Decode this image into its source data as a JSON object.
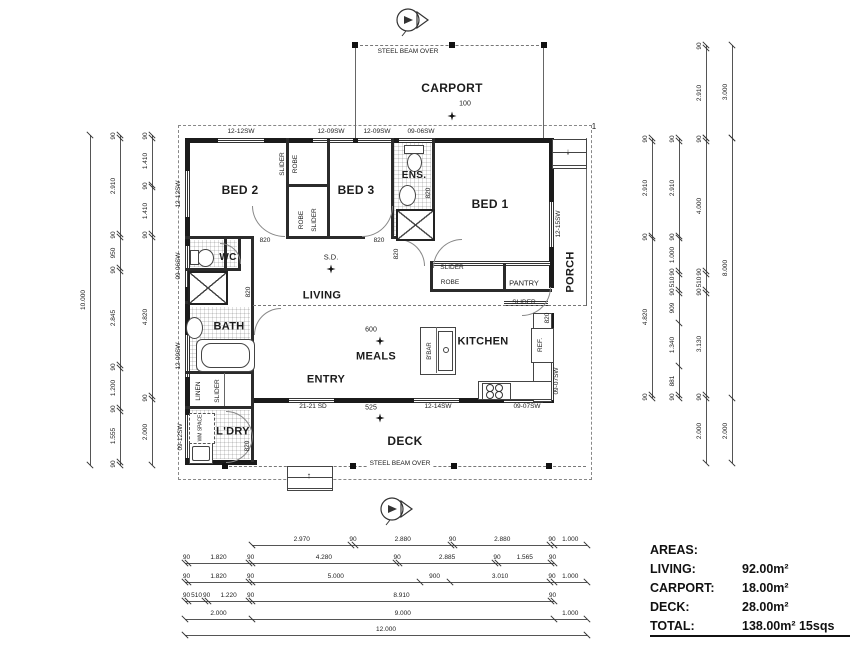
{
  "areas": {
    "title": "AREAS:",
    "rows": [
      {
        "label": "LIVING:",
        "value": "92.00m²"
      },
      {
        "label": "CARPORT:",
        "value": "18.00m²"
      },
      {
        "label": "DECK:",
        "value": "28.00m²"
      }
    ],
    "total": {
      "label": "TOTAL:",
      "value": "138.00m² 15sqs"
    }
  },
  "plan": {
    "labels": [
      {
        "t": "BED 2",
        "x": 240,
        "y": 190,
        "s": 12,
        "b": 1,
        "n": "room-bed2"
      },
      {
        "t": "BED 3",
        "x": 356,
        "y": 190,
        "s": 12,
        "b": 1,
        "n": "room-bed3"
      },
      {
        "t": "BED 1",
        "x": 490,
        "y": 204,
        "s": 12,
        "b": 1,
        "n": "room-bed1"
      },
      {
        "t": "ENS.",
        "x": 414,
        "y": 176,
        "s": 10,
        "b": 1,
        "n": "room-ensuite"
      },
      {
        "t": "WC",
        "x": 228,
        "y": 258,
        "s": 10,
        "b": 1,
        "n": "room-wc"
      },
      {
        "t": "BATH",
        "x": 229,
        "y": 327,
        "s": 11,
        "b": 1,
        "n": "room-bath"
      },
      {
        "t": "L'DRY",
        "x": 233,
        "y": 432,
        "s": 11,
        "b": 1,
        "n": "room-laundry"
      },
      {
        "t": "LIVING",
        "x": 322,
        "y": 296,
        "s": 11,
        "b": 1,
        "n": "room-living"
      },
      {
        "t": "MEALS",
        "x": 376,
        "y": 357,
        "s": 11,
        "b": 1,
        "n": "room-meals"
      },
      {
        "t": "KITCHEN",
        "x": 483,
        "y": 342,
        "s": 11,
        "b": 1,
        "n": "room-kitchen"
      },
      {
        "t": "ENTRY",
        "x": 326,
        "y": 380,
        "s": 11,
        "b": 1,
        "n": "room-entry"
      },
      {
        "t": "DECK",
        "x": 405,
        "y": 441,
        "s": 12,
        "b": 1,
        "n": "room-deck"
      },
      {
        "t": "CARPORT",
        "x": 452,
        "y": 88,
        "s": 12,
        "b": 1,
        "n": "room-carport"
      },
      {
        "t": "PORCH",
        "x": 571,
        "y": 272,
        "s": 11,
        "b": 1,
        "v": 1,
        "n": "room-porch"
      },
      {
        "t": "SLIDER",
        "x": 283,
        "y": 164,
        "v": 1,
        "n": "robe-slider-bed2"
      },
      {
        "t": "ROBE",
        "x": 296,
        "y": 164,
        "v": 1,
        "n": "robe-bed2"
      },
      {
        "t": "ROBE",
        "x": 302,
        "y": 220,
        "v": 1,
        "n": "robe-bed3"
      },
      {
        "t": "SLIDER",
        "x": 315,
        "y": 220,
        "v": 1,
        "n": "robe-slider-bed3"
      },
      {
        "t": "SLIDER",
        "x": 452,
        "y": 268,
        "n": "robe-slider-bed1"
      },
      {
        "t": "ROBE",
        "x": 450,
        "y": 283,
        "n": "robe-bed1"
      },
      {
        "t": "PANTRY",
        "x": 524,
        "y": 283,
        "s": 7.5,
        "n": "pantry"
      },
      {
        "t": "SLIDER",
        "x": 524,
        "y": 303,
        "n": "pantry-slider"
      },
      {
        "t": "LINEN",
        "x": 199,
        "y": 391,
        "v": 1,
        "n": "linen"
      },
      {
        "t": "SLIDER",
        "x": 218,
        "y": 391,
        "v": 1,
        "n": "linen-slider"
      },
      {
        "t": "WM SPACE",
        "x": 201,
        "y": 428,
        "v": 1,
        "s": 5,
        "n": "wm-space"
      },
      {
        "t": "REF.",
        "x": 541,
        "y": 345,
        "v": 1,
        "n": "fridge"
      },
      {
        "t": "B'BAR",
        "x": 430,
        "y": 351,
        "v": 1,
        "s": 6,
        "n": "breakfast-bar"
      },
      {
        "t": "12-12SW",
        "x": 241,
        "y": 132,
        "n": "window-top-1"
      },
      {
        "t": "12-09SW",
        "x": 331,
        "y": 132,
        "n": "window-top-2"
      },
      {
        "t": "12-09SW",
        "x": 377,
        "y": 132,
        "n": "window-top-3"
      },
      {
        "t": "09-06SW",
        "x": 421,
        "y": 132,
        "n": "window-top-4"
      },
      {
        "t": "12-12SW",
        "x": 179,
        "y": 194,
        "v": 1,
        "n": "window-left-1"
      },
      {
        "t": "09-06SW",
        "x": 179,
        "y": 266,
        "v": 1,
        "n": "window-left-2"
      },
      {
        "t": "12-09SW",
        "x": 179,
        "y": 356,
        "v": 1,
        "n": "window-left-3"
      },
      {
        "t": "09-12SW",
        "x": 181,
        "y": 437,
        "v": 1,
        "n": "window-left-4"
      },
      {
        "t": "12-15SW",
        "x": 559,
        "y": 224,
        "v": 1,
        "n": "window-right-1"
      },
      {
        "t": "09-07SW",
        "x": 557,
        "y": 381,
        "v": 1,
        "n": "window-right-2"
      },
      {
        "t": "21-21 SD",
        "x": 313,
        "y": 407,
        "n": "sliding-door-entry"
      },
      {
        "t": "12-14SW",
        "x": 438,
        "y": 407,
        "n": "window-bottom-1"
      },
      {
        "t": "09-07SW",
        "x": 527,
        "y": 407,
        "n": "window-bottom-2"
      },
      {
        "t": "820",
        "x": 265,
        "y": 241,
        "s": 6.5,
        "n": "door-820-bed2"
      },
      {
        "t": "820",
        "x": 379,
        "y": 241,
        "s": 6.5,
        "n": "door-820-bed3"
      },
      {
        "t": "820",
        "x": 397,
        "y": 254,
        "v": 1,
        "s": 6.5,
        "n": "door-820-hall"
      },
      {
        "t": "820",
        "x": 429,
        "y": 193,
        "v": 1,
        "s": 6.5,
        "n": "door-820-ens"
      },
      {
        "t": "820",
        "x": 548,
        "y": 318,
        "v": 1,
        "s": 6.5,
        "n": "door-820-porch"
      },
      {
        "t": "820",
        "x": 249,
        "y": 292,
        "v": 1,
        "s": 6.5,
        "n": "door-820-bath"
      },
      {
        "t": "820",
        "x": 248,
        "y": 446,
        "v": 1,
        "s": 6.5,
        "n": "door-820-laundry"
      },
      {
        "t": "STEEL BEAM OVER",
        "x": 408,
        "y": 52,
        "s": 6.5,
        "g": 1,
        "n": "steel-beam-over-top"
      },
      {
        "t": "STEEL BEAM OVER",
        "x": 400,
        "y": 464,
        "s": 6.5,
        "g": 1,
        "n": "steel-beam-over-bottom"
      },
      {
        "t": "100",
        "x": 465,
        "y": 104,
        "s": 7,
        "n": "post-size-100"
      },
      {
        "t": "600",
        "x": 371,
        "y": 330,
        "s": 7,
        "n": "post-size-600"
      },
      {
        "t": "525",
        "x": 371,
        "y": 408,
        "s": 7,
        "n": "post-size-525"
      },
      {
        "t": "S.D.",
        "x": 331,
        "y": 257,
        "s": 7.5,
        "n": "smoke-detector"
      },
      {
        "t": "1",
        "x": 594,
        "y": 127,
        "s": 8,
        "n": "grid-marker-1"
      },
      {
        "t": "↓",
        "x": 568,
        "y": 152,
        "s": 9,
        "n": "porch-steps-arrow"
      },
      {
        "t": "↑",
        "x": 309,
        "y": 476,
        "s": 9,
        "n": "deck-steps-arrow"
      }
    ],
    "dimensions": [
      {
        "n": "dim-left-overall",
        "dir": "v",
        "x": 90,
        "y": 135,
        "len": 330,
        "vals": [
          "10.000"
        ]
      },
      {
        "n": "dim-left-mid",
        "dir": "v",
        "x": 120,
        "y": 135,
        "len": 330,
        "vals": [
          "90",
          "2.910",
          "90",
          "950",
          "90",
          "2.845",
          "90",
          "1.200",
          "90",
          "1.555",
          "90"
        ]
      },
      {
        "n": "dim-left-inner",
        "dir": "v",
        "x": 152,
        "y": 135,
        "len": 330,
        "vals": [
          "90",
          "1.410",
          "90",
          "1.410",
          "90",
          "4.820",
          "90",
          "2.000"
        ]
      },
      {
        "n": "dim-right-carport-inner",
        "dir": "v",
        "x": 706,
        "y": 45,
        "len": 93,
        "vals": [
          "90",
          "2.910"
        ]
      },
      {
        "n": "dim-right-carport-outer",
        "dir": "v",
        "x": 732,
        "y": 45,
        "len": 93,
        "vals": [
          "3.000"
        ]
      },
      {
        "n": "dim-right-1",
        "dir": "v",
        "x": 652,
        "y": 138,
        "len": 260,
        "vals": [
          "90",
          "2.910",
          "90",
          "4.820",
          "90"
        ]
      },
      {
        "n": "dim-right-2",
        "dir": "v",
        "x": 679,
        "y": 138,
        "len": 260,
        "vals": [
          "90",
          "2.910",
          "90",
          "1.000",
          "90",
          "510",
          "90",
          "909",
          "1.340",
          "881",
          "90"
        ]
      },
      {
        "n": "dim-right-3",
        "dir": "v",
        "x": 706,
        "y": 138,
        "len": 325,
        "vals": [
          "90",
          "4.000",
          "90",
          "510",
          "90",
          "3.130",
          "90",
          "2.000"
        ]
      },
      {
        "n": "dim-right-overall",
        "dir": "v",
        "x": 732,
        "y": 138,
        "len": 325,
        "vals": [
          "8.000",
          "2.000"
        ]
      },
      {
        "n": "dim-bottom-1",
        "dir": "h",
        "x": 252,
        "y": 545,
        "len": 335,
        "vals": [
          "2.970",
          "90",
          "2.880",
          "90",
          "2.880",
          "90",
          "1.000"
        ]
      },
      {
        "n": "dim-bottom-2",
        "dir": "h",
        "x": 185,
        "y": 563,
        "len": 369,
        "vals": [
          "90",
          "1.820",
          "90",
          "4.280",
          "90",
          "2.885",
          "90",
          "1.565",
          "90"
        ]
      },
      {
        "n": "dim-bottom-3",
        "dir": "h",
        "x": 185,
        "y": 582,
        "len": 402,
        "vals": [
          "90",
          "1.820",
          "90",
          "5.000",
          "900",
          "3.010",
          "90",
          "1.000"
        ]
      },
      {
        "n": "dim-bottom-4",
        "dir": "h",
        "x": 185,
        "y": 601,
        "len": 369,
        "vals": [
          "90",
          "510",
          "90",
          "1.220",
          "90",
          "8.910",
          "90"
        ]
      },
      {
        "n": "dim-bottom-5",
        "dir": "h",
        "x": 185,
        "y": 619,
        "len": 402,
        "vals": [
          "2.000",
          "9.000",
          "1.000"
        ]
      },
      {
        "n": "dim-bottom-overall",
        "dir": "h",
        "x": 185,
        "y": 635,
        "len": 402,
        "vals": [
          "12.000"
        ]
      }
    ]
  }
}
